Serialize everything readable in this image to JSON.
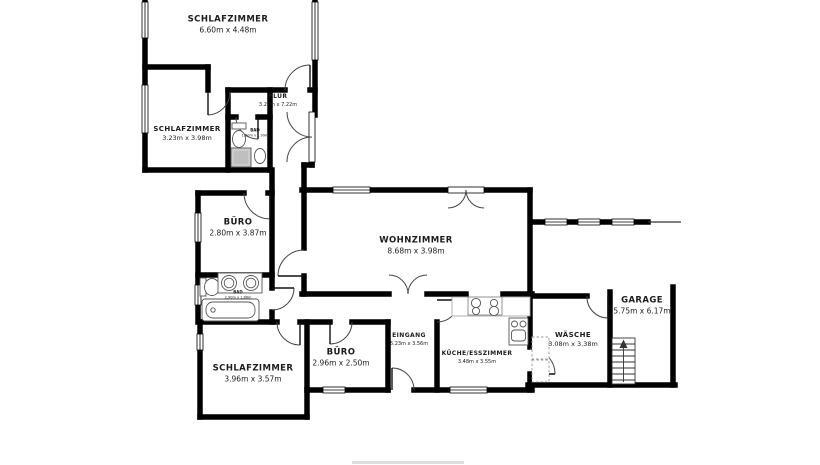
{
  "floorplan": {
    "colors": {
      "wall": "#000000",
      "text": "#1c1c1c",
      "fixture": "#555555",
      "shower_fill": "#cccccc"
    },
    "rooms": [
      {
        "id": "schlafzimmer-top",
        "name": "SCHLAFZIMMER",
        "dims": "6.60m x 4.48m"
      },
      {
        "id": "flur",
        "name": "FLUR",
        "dims": "3.27m x 7.22m"
      },
      {
        "id": "schlafzimmer-left",
        "name": "SCHLAFZIMMER",
        "dims": "3.23m x 3.98m"
      },
      {
        "id": "bad-upper",
        "name": "BAD",
        "dims": "1.50m x 1.99m"
      },
      {
        "id": "buero-upper",
        "name": "BÜRO",
        "dims": "2.80m x 3.87m"
      },
      {
        "id": "wohnzimmer",
        "name": "WOHNZIMMER",
        "dims": "8.68m x 3.98m"
      },
      {
        "id": "bad-lower",
        "name": "BAD",
        "dims": "2.90m x 1.86m"
      },
      {
        "id": "schlafzimmer-bottom",
        "name": "SCHLAFZIMMER",
        "dims": "3.96m x 3.57m"
      },
      {
        "id": "buero-lower",
        "name": "BÜRO",
        "dims": "2.96m x 2.50m"
      },
      {
        "id": "eingang",
        "name": "EINGANG",
        "dims": "6.23m x 3.56m"
      },
      {
        "id": "kueche",
        "name": "KÜCHE/ESSZIMMER",
        "dims": "3.48m x 3.55m"
      },
      {
        "id": "waesche",
        "name": "WÄSCHE",
        "dims": "3.08m x 3.38m"
      },
      {
        "id": "garage",
        "name": "GARAGE",
        "dims": "5.75m x 6.17m"
      }
    ]
  }
}
